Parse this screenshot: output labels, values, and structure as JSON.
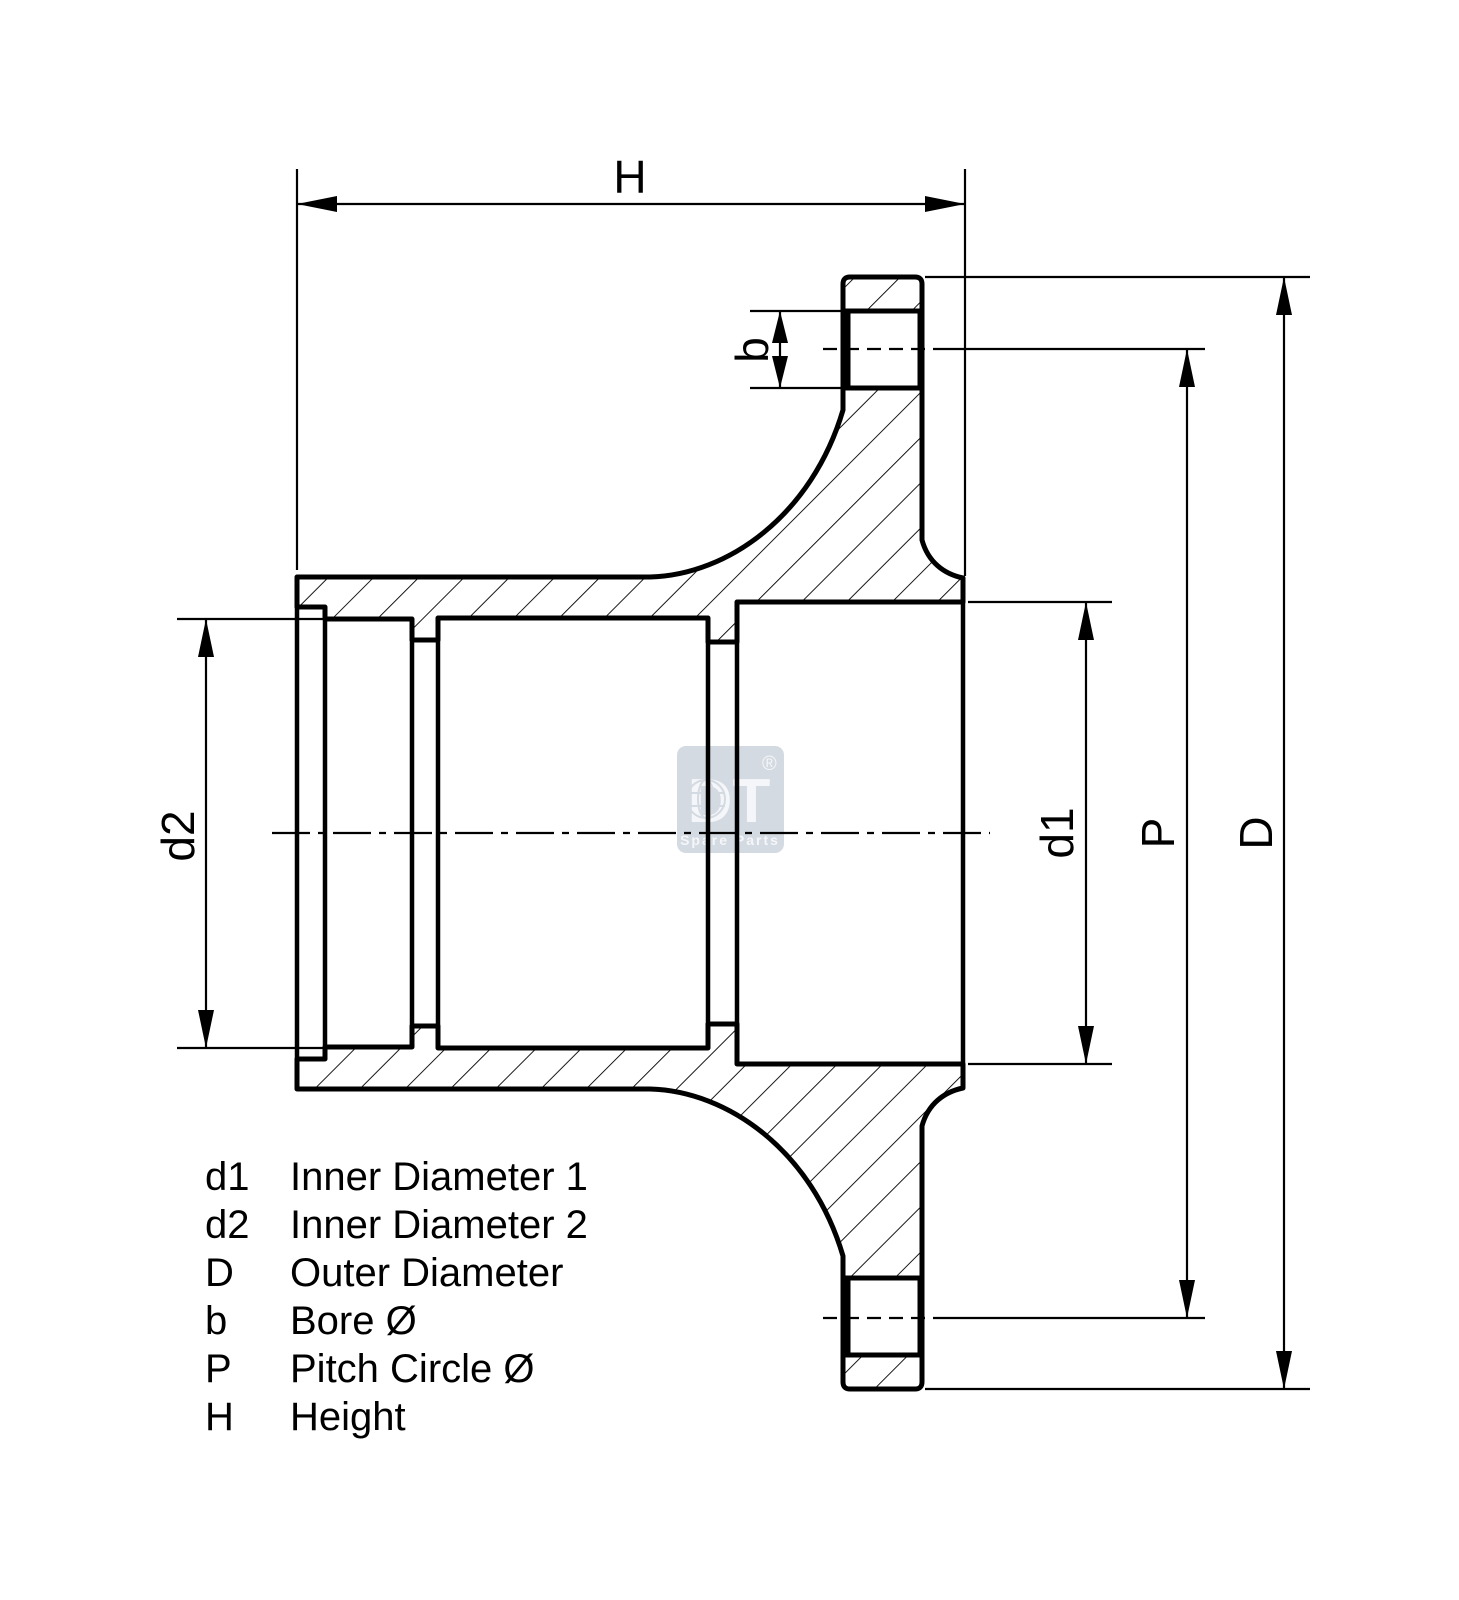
{
  "drawing": {
    "labels": {
      "height": "H",
      "bore": "b",
      "inner_diameter_2": "d2",
      "inner_diameter_1": "d1",
      "pitch_circle": "P",
      "outer_diameter": "D"
    },
    "legend": {
      "rows": [
        {
          "symbol": "d1",
          "description": "Inner Diameter 1"
        },
        {
          "symbol": "d2",
          "description": "Inner Diameter 2"
        },
        {
          "symbol": "D",
          "description": "Outer Diameter"
        },
        {
          "symbol": "b",
          "description": "Bore Ø"
        },
        {
          "symbol": "P",
          "description": "Pitch Circle Ø"
        },
        {
          "symbol": "H",
          "description": "Height"
        }
      ]
    },
    "watermark": {
      "brand": "DT",
      "registered": "®",
      "tagline": "Spare Parts"
    },
    "colors": {
      "line": "#000000",
      "background": "#ffffff",
      "watermark_box": "#cfd6de",
      "watermark_text": "#f4f6f9"
    }
  }
}
